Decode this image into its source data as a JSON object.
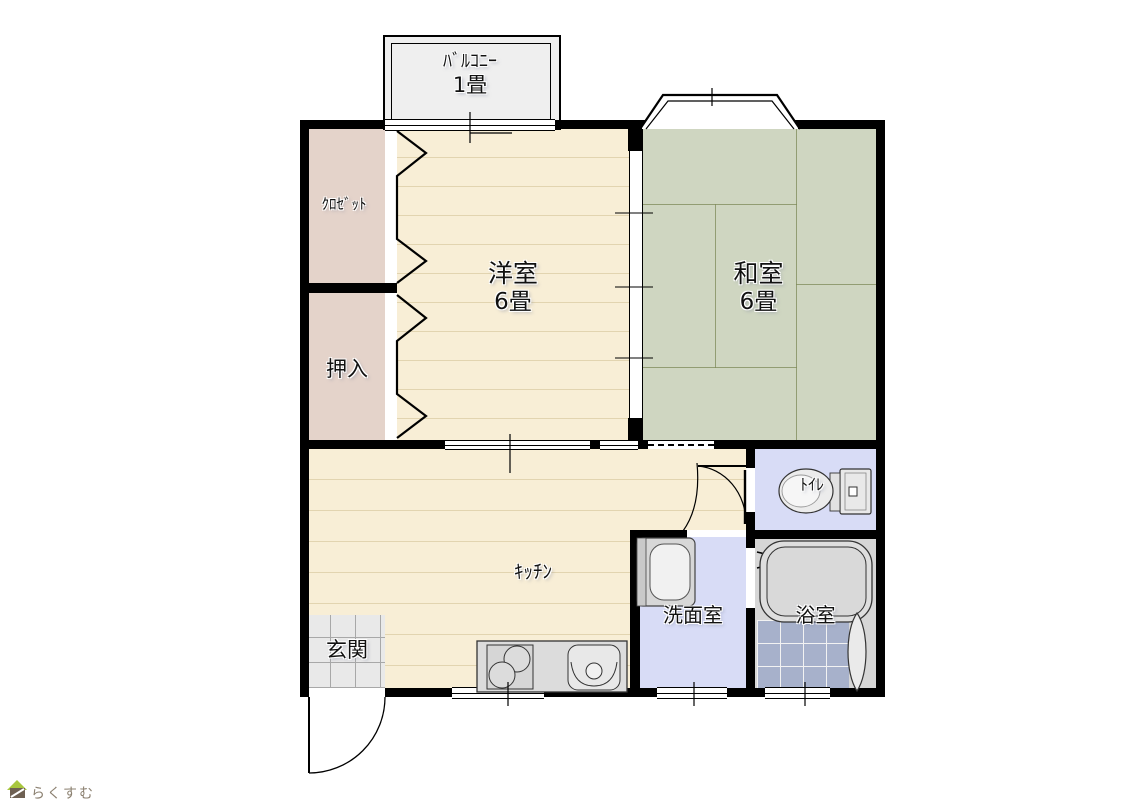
{
  "floorplan": {
    "balcony": {
      "name": "ﾊﾞﾙｺﾆｰ",
      "size": "1畳"
    },
    "closet": {
      "name": "ｸﾛｾﾞｯﾄ"
    },
    "oshiire": {
      "name": "押入"
    },
    "western_room": {
      "name": "洋室",
      "size": "6畳"
    },
    "japanese_room": {
      "name": "和室",
      "size": "6畳"
    },
    "kitchen": {
      "name": "ｷｯﾁﾝ"
    },
    "entrance": {
      "name": "玄関"
    },
    "washroom": {
      "name": "洗面室"
    },
    "bathroom": {
      "name": "浴室"
    },
    "toilet": {
      "name": "ﾄｲﾚ"
    }
  },
  "branding": {
    "logo_text": "らくすむ"
  },
  "colors": {
    "wall": "#000000",
    "wood_floor": "#f8eed6",
    "tatami_floor": "#cfd6c1",
    "closet_floor": "#e4d3ca",
    "wet_area_floor": "#d8dcf6",
    "bath_tile": "#a7b1cb",
    "entrance_tile": "#e9e9e9",
    "balcony_floor": "#efefef",
    "fixture_gray": "#dcdcdc"
  }
}
